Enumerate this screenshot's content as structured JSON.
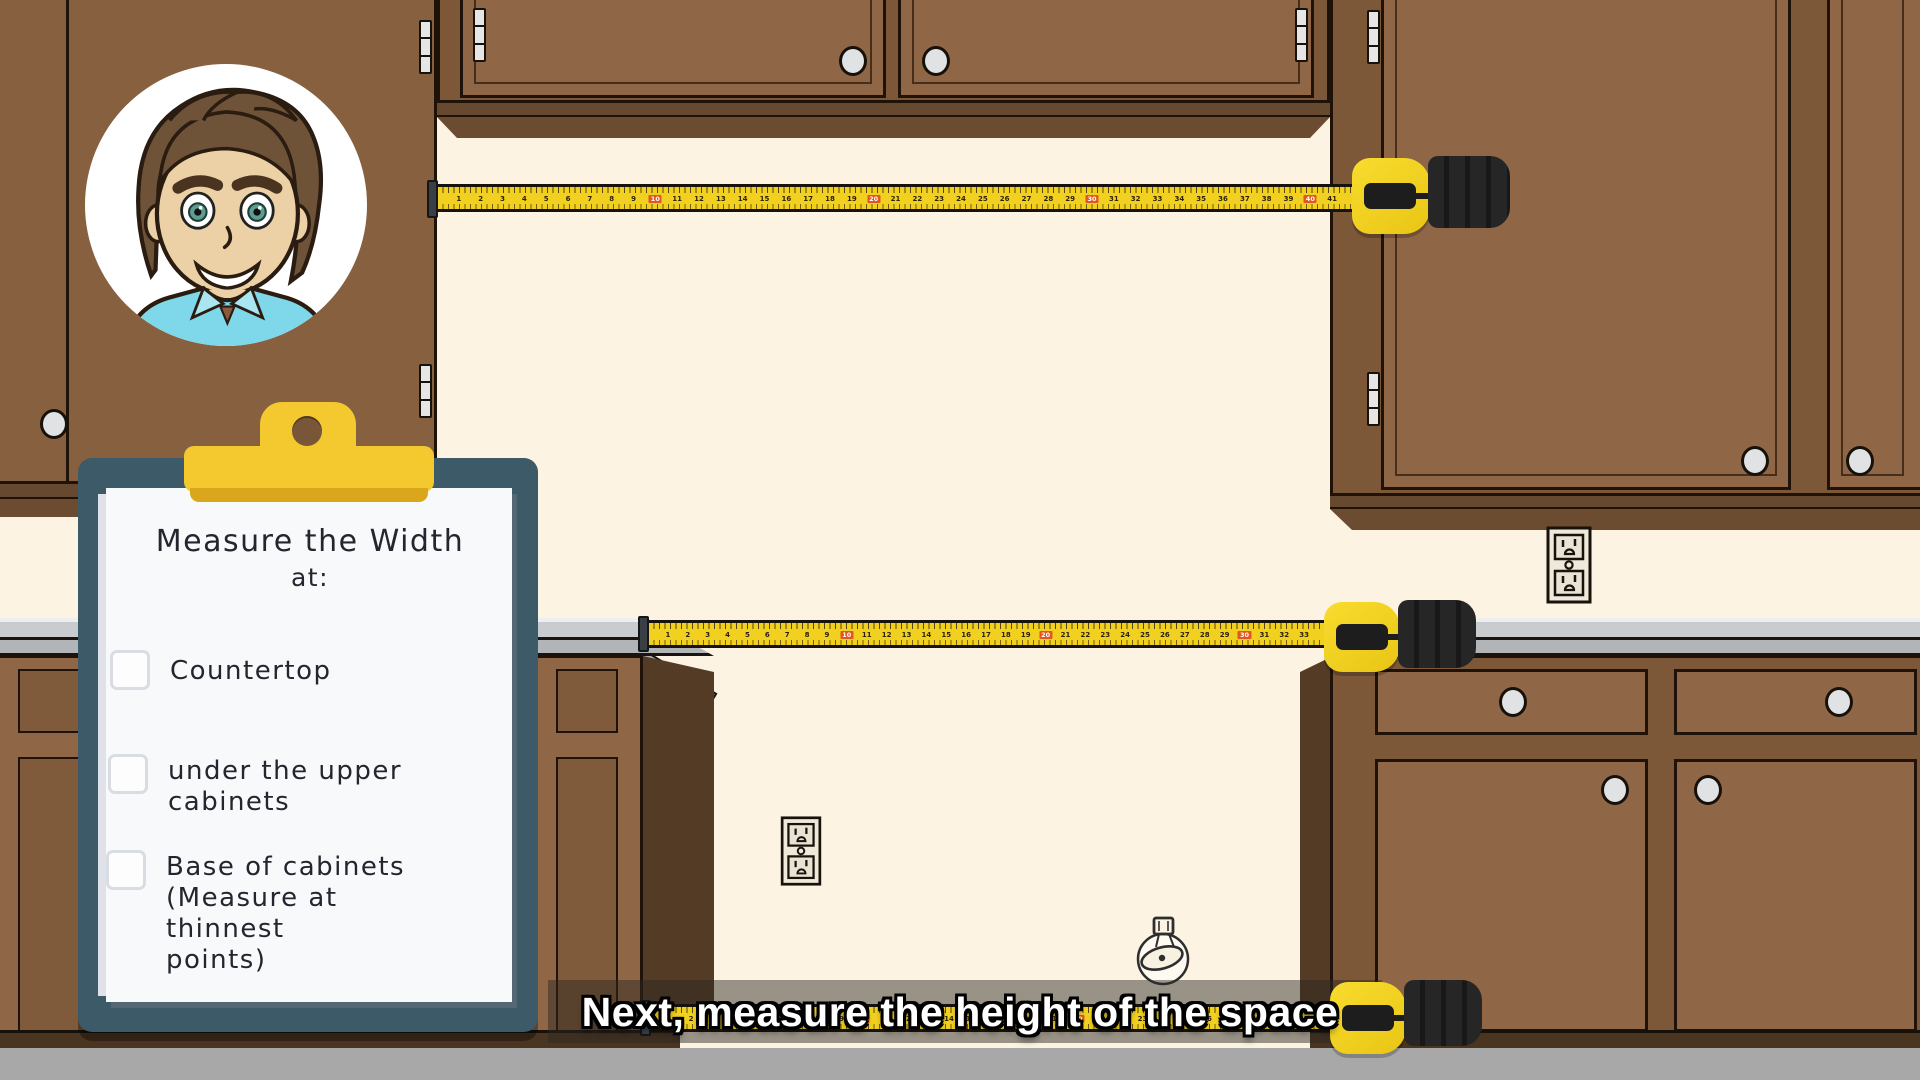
{
  "caption": {
    "text": "Next, measure the height of the space"
  },
  "clipboard": {
    "heading": "Measure the Width",
    "heading_suffix": "at:",
    "items": [
      {
        "label": "Countertop",
        "checked": false
      },
      {
        "label": "under the upper cabinets",
        "checked": false
      },
      {
        "label": "Base of cabinets",
        "note": "(Measure at thinnest points)",
        "checked": false
      }
    ]
  },
  "tapes": [
    {
      "name": "upper-cabinet-gap-tape",
      "count": 41,
      "highlight_every": 10
    },
    {
      "name": "countertop-gap-tape",
      "count": 33,
      "highlight_every": 10
    },
    {
      "name": "base-cabinet-gap-tape",
      "count": 31,
      "highlight_every": 10
    }
  ],
  "icons": {
    "avatar": "cartoon-man-presenter",
    "outlet": "duplex-power-outlet",
    "doodle": "tape-measure-sketch"
  },
  "colors": {
    "wall": "#fcf3e2",
    "cabinet": "#8f6746",
    "cabinet_frame": "#7c5738",
    "counter": "#c9ccce",
    "tape_yellow": "#f2d01f",
    "tape_highlight": "#e2571d",
    "clipboard_board": "#3c5a67",
    "clip_yellow": "#f4c930",
    "paper": "#f8f9fb",
    "caption_text": "#ffffff",
    "floor": "#a8a8a8"
  }
}
